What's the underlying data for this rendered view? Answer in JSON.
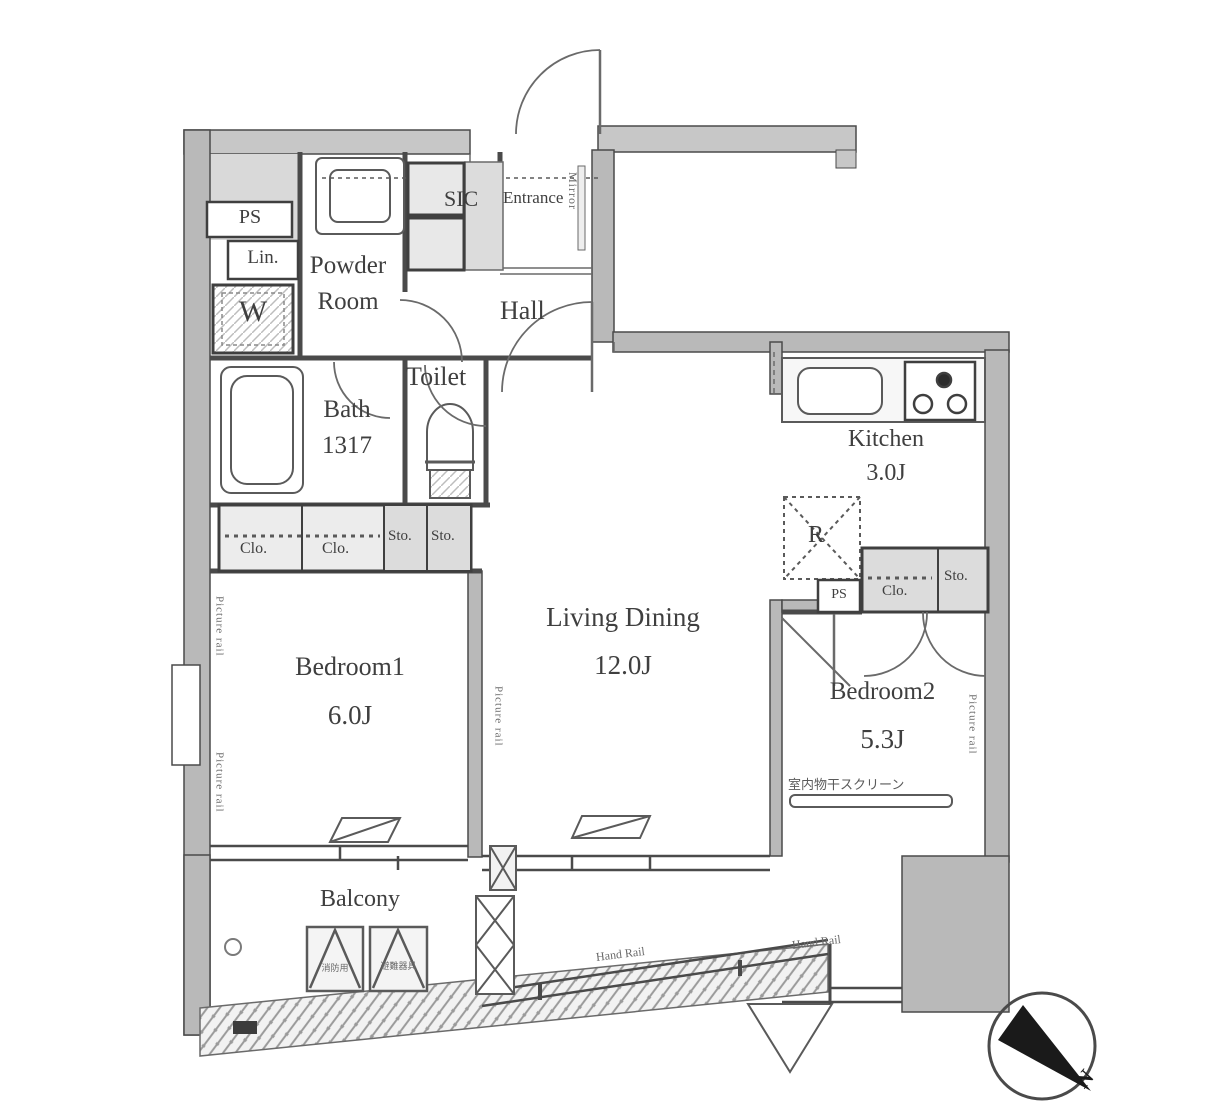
{
  "plan": {
    "title": "apartment-floor-plan",
    "colors": {
      "wall": "#b9b9b9",
      "shade": "#d9d9d9",
      "line": "#4a4a4a",
      "text": "#3f3f3f",
      "compass": "#1a1a1a"
    },
    "rooms": {
      "powder_room": {
        "line1": "Powder",
        "line2": "Room"
      },
      "hall": "Hall",
      "entrance": "Entrance",
      "sic": "SIC",
      "toilet": "Toilet",
      "bath": {
        "name": "Bath",
        "size": "1317"
      },
      "bedroom1": {
        "name": "Bedroom1",
        "area": "6.0J"
      },
      "living_dining": {
        "name": "Living Dining",
        "area": "12.0J"
      },
      "kitchen": {
        "name": "Kitchen",
        "area": "3.0J"
      },
      "bedroom2": {
        "name": "Bedroom2",
        "area": "5.3J"
      },
      "balcony": "Balcony"
    },
    "storage": {
      "ps_top": "PS",
      "linen": "Lin.",
      "washer": "W",
      "clo1": "Clo.",
      "clo2": "Clo.",
      "sto1": "Sto.",
      "sto2": "Sto.",
      "fridge": "R",
      "ps_kitchen": "PS",
      "clo_kitchen": "Clo.",
      "sto_kitchen": "Sto."
    },
    "annotations": {
      "mirror": "Mirror",
      "picture_rail": "Picture rail",
      "hand_rail_1": "Hand Rail",
      "hand_rail_2": "Hand Rail",
      "laundry_screen": "室内物干スクリーン",
      "hatch_left": "消防用",
      "hatch_right": "避難器具",
      "compass_north": "N"
    }
  }
}
